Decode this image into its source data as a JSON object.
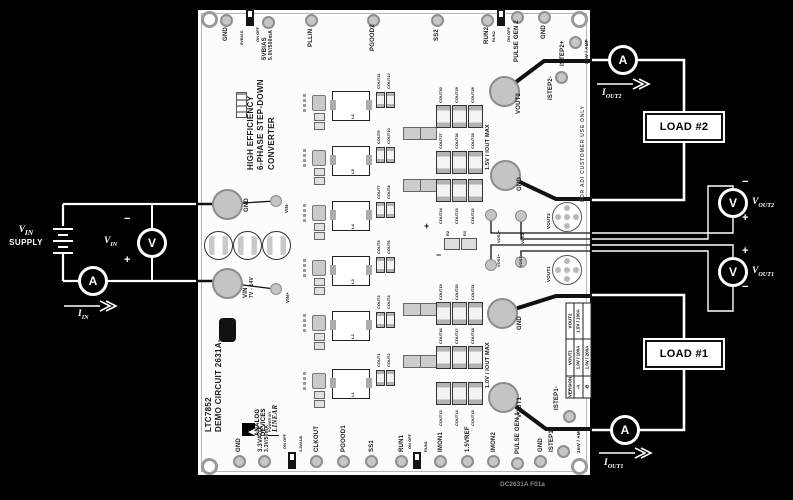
{
  "figure": {
    "footer_code": "DC2631A F01a"
  },
  "external": {
    "supply": {
      "sym": "V",
      "sub": "IN",
      "line2": "SUPPLY"
    },
    "ammeter_letter": "A",
    "voltmeter_letter": "V",
    "signals": {
      "iin": {
        "sym": "I",
        "sub": "IN"
      },
      "iout1": {
        "sym": "I",
        "sub": "OUT1"
      },
      "iout2": {
        "sym": "I",
        "sub": "OUT2"
      },
      "vin": {
        "sym": "V",
        "sub": "IN"
      },
      "vout1": {
        "sym": "V",
        "sub": "OUT1"
      },
      "vout2": {
        "sym": "V",
        "sub": "OUT2"
      }
    },
    "polarity": {
      "plus": "+",
      "minus": "−"
    },
    "load1": "LOAD #1",
    "load2": "LOAD #2"
  },
  "board": {
    "edge_note": "FOR ADI CUSTOMER USE ONLY",
    "title": [
      "HIGH EFFICIENCY",
      "6-PHASE STEP-DOWN",
      "CONVERTER"
    ],
    "model": [
      "LTC7852",
      "DEMO CIRCUIT 2631A-"
    ],
    "logo": {
      "brand1": "ANALOG",
      "brand2": "DEVICES",
      "power_by": "POWER BY",
      "linear": "LINEAR"
    },
    "top_row": {
      "gnd1": "GND",
      "sw_5vbias": {
        "name": "5VBIAS",
        "onoff": "ON OFF"
      },
      "bias": [
        "5VBIAS",
        "5.0V/500mA"
      ],
      "pllin": "PLLIN",
      "pgood2": "PGOOD2",
      "ss2": "SS2",
      "run2": "RUN2",
      "sw_run2": {
        "name": "RUN2",
        "onoff": "ON OFF"
      },
      "pulse_gen2": "PULSE GEN 2",
      "gnd2": "GND",
      "istep2_plus": "ISTEP2+",
      "istep2_note": "2mV / AMP",
      "istep2_minus": "ISTEP2-"
    },
    "left_edge": {
      "gnd": "GND",
      "vin_minus": "VIN-",
      "vin": [
        "VIN",
        "7V - 14V"
      ],
      "vin_plus": "VIN+"
    },
    "out2": {
      "pad": "VOUT2",
      "gnd": "GND",
      "max": "1.5V / IOUT MAX",
      "caps": [
        [
          "COUT30",
          "COUT29",
          "COUT28"
        ],
        [
          "COUT27",
          "COUT26",
          "COUT25"
        ],
        [
          "COUT24",
          "COUT23",
          "COUT22"
        ]
      ]
    },
    "out1": {
      "pad": "VOUT1",
      "gnd": "GND",
      "max": "1.0V / IOUT MAX",
      "caps": [
        [
          "COUT19",
          "COUT20",
          "COUT21"
        ],
        [
          "COUT16",
          "COUT17",
          "COUT18"
        ],
        [
          "COUT13",
          "COUT14",
          "COUT15"
        ]
      ]
    },
    "sense": {
      "vos2_plus": "VOS2+",
      "vos2_minus": "VOS2-",
      "vos1_plus": "VOS1+",
      "vos1_minus": "VOS1-",
      "r2": "R2",
      "r1": "R1",
      "plus": "+",
      "minus": "−"
    },
    "jacks": {
      "vout2": "VOUT2",
      "vout1": "VOUT1"
    },
    "phases": {
      "inductors": [
        "L6",
        "L5",
        "L4",
        "L3",
        "L2",
        "L1"
      ],
      "cap_pairs": [
        [
          "COUT11",
          "COUT12"
        ],
        [
          "COUT9",
          "COUT10"
        ],
        [
          "COUT7",
          "COUT8"
        ],
        [
          "COUT5",
          "COUT6"
        ],
        [
          "COUT3",
          "COUT4"
        ],
        [
          "COUT1",
          "COUT2"
        ]
      ]
    },
    "table": {
      "headers": [
        "VERSION",
        "VOUT1",
        "VOUT2"
      ],
      "rows": [
        [
          "-A",
          "1.0V / 100A",
          "1.5V / 100A"
        ],
        [
          "-B",
          "1.0V / 200A",
          ""
        ]
      ]
    },
    "bottom_row": {
      "gnd1": "GND",
      "aux": [
        "3.3VAUX",
        "3.3V/50mA"
      ],
      "sw_aux": {
        "name": "3.3VAUX",
        "onoff": "ON OFF"
      },
      "clkout": "CLKOUT",
      "pgood1": "PGOOD1",
      "ss1": "SS1",
      "run1": "RUN1",
      "sw_run1": {
        "name": "RUN1",
        "onoff": "ON OFF"
      },
      "imon1": "IMON1",
      "vref": "1.5VREF",
      "imon2": "IMON2",
      "pulse_gen1": "PULSE GEN 1",
      "gnd2": "GND",
      "istep1_plus": "ISTEP1+",
      "istep1_note": "2mV / AMP",
      "istep1_minus": "ISTEP1-"
    }
  }
}
